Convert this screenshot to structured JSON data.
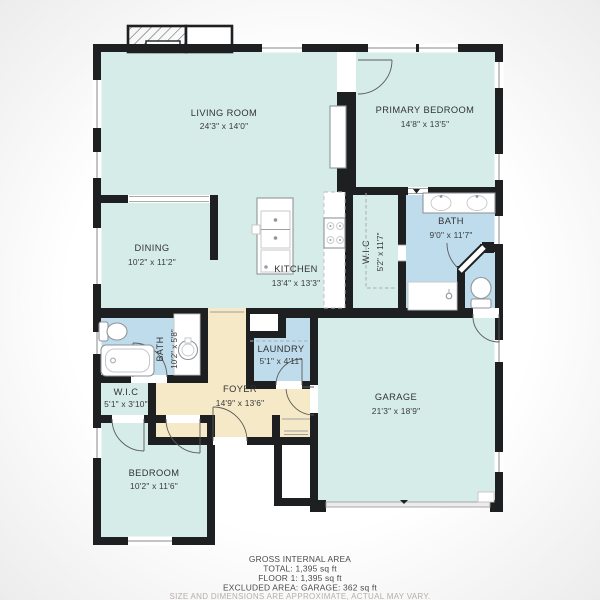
{
  "rooms": {
    "living": {
      "name": "LIVING ROOM",
      "dims": "24'3\" x 14'0\""
    },
    "primary": {
      "name": "PRIMARY BEDROOM",
      "dims": "14'8\" x 13'5\""
    },
    "dining": {
      "name": "DINING",
      "dims": "10'2\" x 11'2\""
    },
    "kitchen": {
      "name": "KITCHEN",
      "dims": "13'4\" x 13'3\""
    },
    "wic1": {
      "name": "W.I.C",
      "dims": "5'2\" x 11'7\""
    },
    "bath1": {
      "name": "BATH",
      "dims": "9'0\" x 11'7\""
    },
    "bath2": {
      "name": "BATH",
      "dims": "10'2\" x 5'8\""
    },
    "laundry": {
      "name": "LAUNDRY",
      "dims": "5'1\" x 4'11\""
    },
    "foyer": {
      "name": "FOYER",
      "dims": "14'9\" x 13'6\""
    },
    "wic2": {
      "name": "W.I.C",
      "dims": "5'1\" x 3'10\""
    },
    "bedroom2": {
      "name": "BEDROOM",
      "dims": "10'2\" x 11'6\""
    },
    "garage": {
      "name": "GARAGE",
      "dims": "21'3\" x 18'9\""
    }
  },
  "footer": {
    "line1": "GROSS INTERNAL AREA",
    "line2": "TOTAL: 1,395 sq ft",
    "line3": "FLOOR 1: 1,395 sq ft",
    "line4": "EXCLUDED AREA: GARAGE: 362 sq ft",
    "disclaimer": "SIZE AND DIMENSIONS ARE APPROXIMATE, ACTUAL MAY VARY."
  },
  "colors": {
    "wall": "#1d1f20",
    "room": "#d5ece8",
    "wet": "#bfdcec",
    "foyer": "#f6e9c8"
  }
}
